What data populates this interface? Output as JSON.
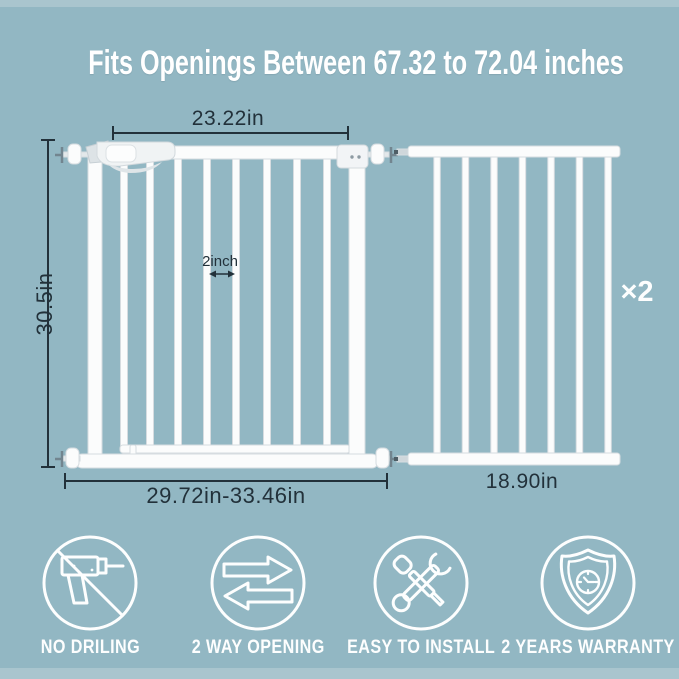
{
  "title": "Fits Openings Between 67.32 to 72.04 inches",
  "diagram": {
    "main_gate": {
      "top_width": "23.22in",
      "height": "30.5in",
      "bottom_width": "29.72in-33.46in",
      "bar_gap": "2inch"
    },
    "extension": {
      "width": "18.90in",
      "quantity": "×2"
    }
  },
  "features": [
    {
      "icon": "no-drilling-icon",
      "label": "NO DRILING"
    },
    {
      "icon": "two-way-opening-icon",
      "label": "2 WAY OPENING"
    },
    {
      "icon": "easy-install-icon",
      "label": "EASY TO INSTALL"
    },
    {
      "icon": "warranty-shield-icon",
      "label": "2 YEARS WARRANTY"
    }
  ],
  "colors": {
    "background": "#92b7c3",
    "edge_band": "#a9c5ce",
    "dimension_ink": "#22313a",
    "gate_white": "#fbfcfc",
    "icon_white": "#fdfefe"
  }
}
